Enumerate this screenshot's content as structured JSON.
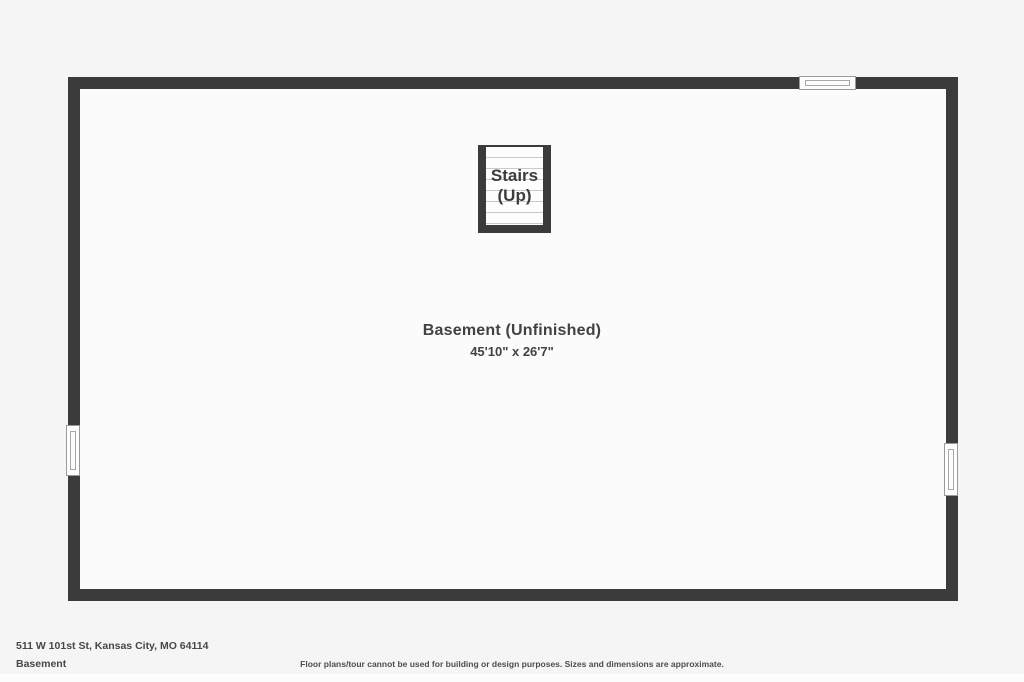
{
  "plan": {
    "stairs": {
      "label_line1": "Stairs",
      "label_line2": "(Up)"
    },
    "room": {
      "name": "Basement (Unfinished)",
      "dimensions": "45'10\" x 26'7\""
    },
    "features": [
      "window-top",
      "window-left",
      "window-right"
    ]
  },
  "footer": {
    "address": "511 W 101st St, Kansas City, MO 64114",
    "floor_label": "Basement",
    "disclaimer": "Floor plans/tour cannot be used for building or design purposes. Sizes and dimensions are approximate."
  },
  "colors": {
    "wall": "#3b3b3b",
    "floor": "#fbfbfb",
    "background": "#f5f5f5",
    "label_text": "#424242",
    "stair_tread_line": "#c9c9c9",
    "window_border": "#9a9a9a"
  }
}
